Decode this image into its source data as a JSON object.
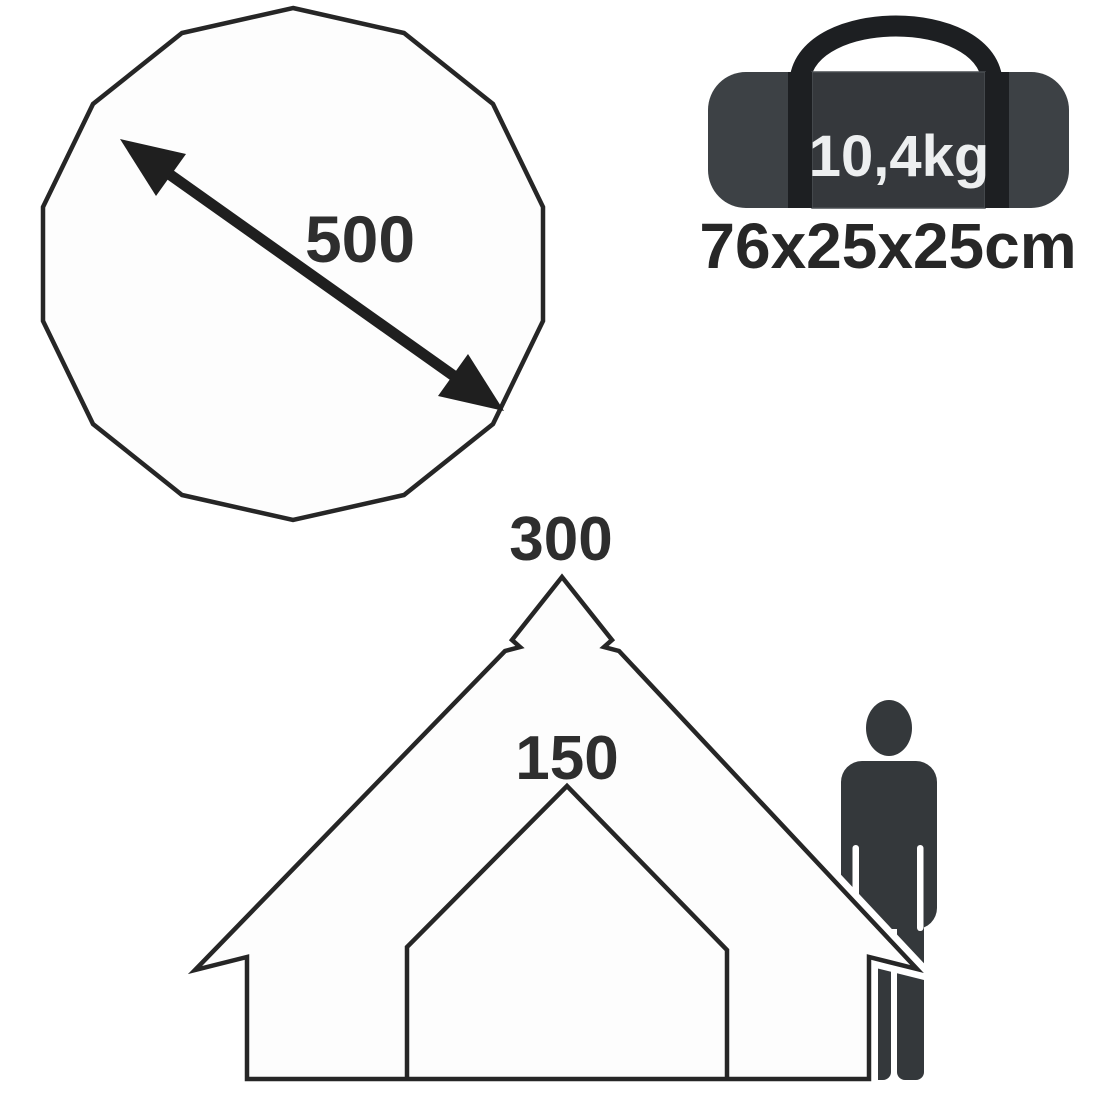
{
  "floorplan": {
    "diameter_label": "500",
    "shape": "14-sided polygon (tent ground plan)",
    "outline_color": "#262626",
    "fill_color": "#fdfdfd",
    "arrow_color": "#1f1f1f"
  },
  "bag": {
    "weight_label": "10,4kg",
    "dimensions_label": "76x25x25cm",
    "body_color": "#3d4145",
    "panel_color": "#35383c",
    "strap_color": "#1d1f22",
    "weight_text_color": "#edeff0",
    "dimensions_text_color": "#272727"
  },
  "tent": {
    "height_label": "300",
    "door_height_label": "150",
    "outline_color": "#262626",
    "fill_color": "#fdfdfd"
  },
  "person": {
    "color": "#34383b"
  },
  "label_color": "#2e2e2e",
  "icons": [
    "tent-floorplan-polygon-icon",
    "diameter-arrow-icon",
    "carry-bag-icon",
    "bell-tent-silhouette-icon",
    "person-scale-icon"
  ]
}
